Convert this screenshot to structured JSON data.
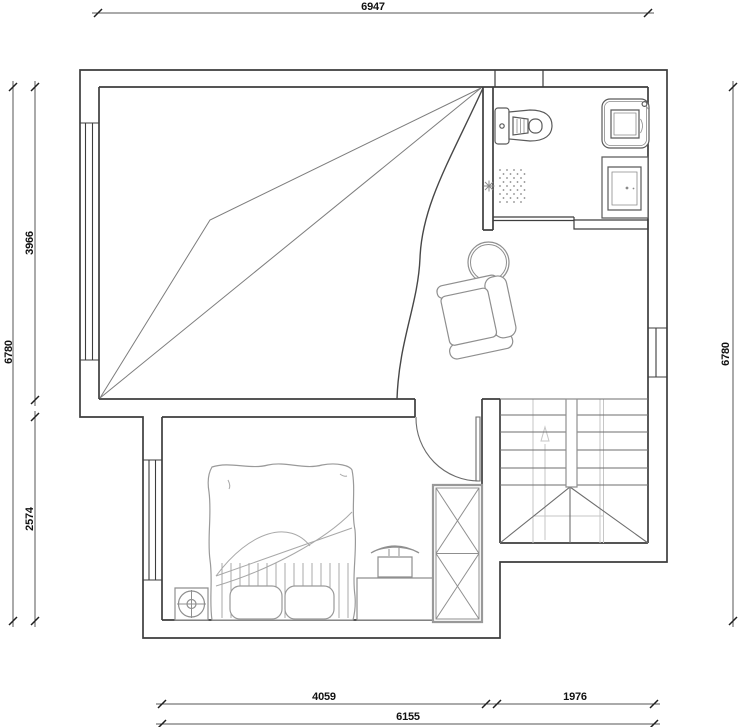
{
  "title": "second-floor-plan",
  "dimensions": {
    "top_width": "6947",
    "left_total_height": "6780",
    "left_upper_height": "3966",
    "left_lower_height": "2574",
    "right_total_height": "6780",
    "bottom_bedroom_width": "4059",
    "bottom_stair_width": "1976",
    "bottom_total_width": "6155"
  },
  "colors": {
    "background": "#ffffff",
    "wall_line": "#3d3d3d",
    "fixture_line": "#5a5a5a",
    "furniture_line": "#8f8f8f",
    "light_line": "#c6c6c6",
    "dimension_line": "#555555",
    "dimension_text": "#111111"
  }
}
